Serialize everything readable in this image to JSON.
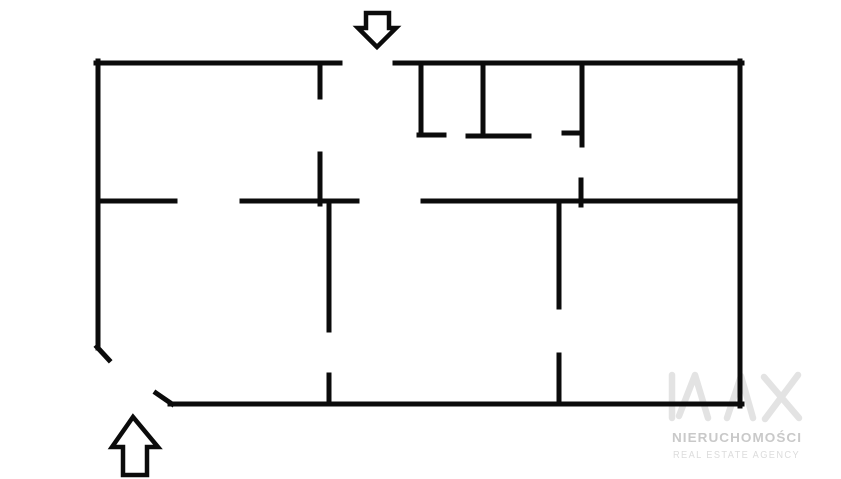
{
  "canvas": {
    "width": 841,
    "height": 479,
    "background": "#ffffff"
  },
  "floorplan": {
    "wall_color": "#0b0b0b",
    "wall_thickness": 5,
    "arrow_stroke_width": 4.5,
    "arrow_fill": "#ffffff",
    "walls": [
      [
        98,
        61,
        98,
        348
      ],
      [
        97,
        347,
        109,
        360
      ],
      [
        156,
        393,
        172,
        404
      ],
      [
        170,
        404,
        742,
        404
      ],
      [
        740,
        61,
        740,
        406
      ],
      [
        96,
        63,
        340,
        63
      ],
      [
        395,
        63,
        742,
        63
      ],
      [
        421,
        63,
        421,
        133
      ],
      [
        419,
        135,
        444,
        135
      ],
      [
        483,
        63,
        483,
        136
      ],
      [
        468,
        136,
        529,
        136
      ],
      [
        582,
        63,
        582,
        145
      ],
      [
        564,
        133,
        582,
        133
      ],
      [
        320,
        63,
        320,
        97
      ],
      [
        320,
        154,
        320,
        204
      ],
      [
        98,
        201,
        175,
        201
      ],
      [
        242,
        201,
        357,
        201
      ],
      [
        423,
        201,
        740,
        201
      ],
      [
        581,
        180,
        581,
        205
      ],
      [
        329,
        201,
        329,
        330
      ],
      [
        329,
        375,
        329,
        404
      ],
      [
        559,
        201,
        559,
        307
      ],
      [
        559,
        355,
        559,
        404
      ]
    ],
    "entrance_arrows": [
      {
        "direction": "down",
        "points": "377,47 358,28 366,28 366,13 389,13 389,28 396,28"
      },
      {
        "direction": "up",
        "points": "133,417 158,447 147,447 147,475 123,475 123,447 112,447"
      }
    ]
  },
  "watermark": {
    "logo_text": "NAX",
    "logo_color": "#e3e3e3",
    "logo_stroke_width": 6.5,
    "logo_strokes": [
      "672,375 672,418",
      "679,416 695,375 708,418",
      "727,418 741,376 753,418",
      "764,377 799,418",
      "798,375 765,419"
    ],
    "agency_name": "NIERUCHOMOŚCI",
    "agency_name_color": "#c9c9c9",
    "tagline": "REAL ESTATE AGENCY",
    "tagline_color": "#dcdcdc"
  }
}
